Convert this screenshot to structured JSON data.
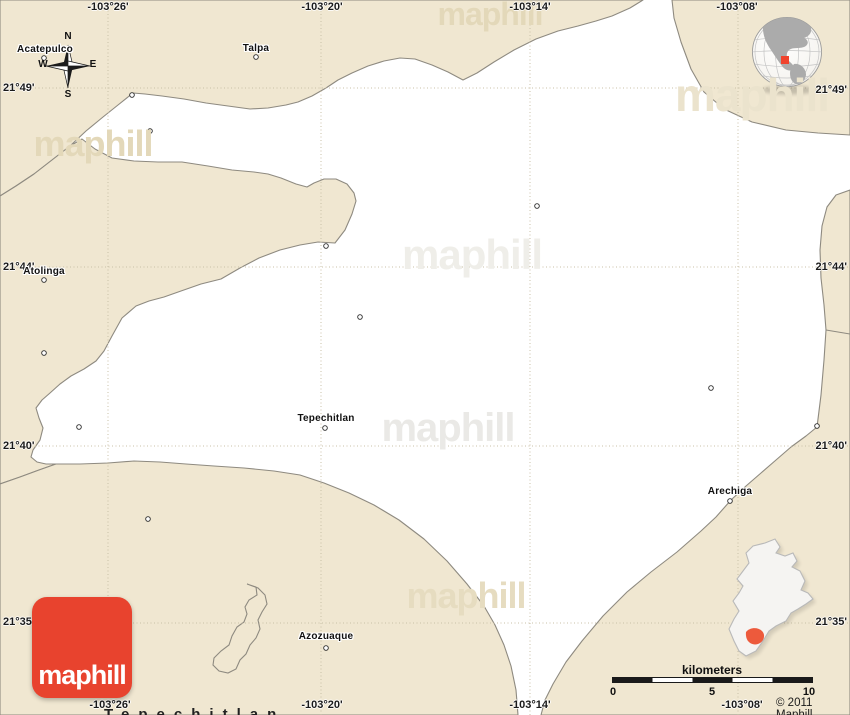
{
  "grid": {
    "lon_top": [
      "-103°26'",
      "-103°20'",
      "-103°14'",
      "-103°08'"
    ],
    "lon_bottom": [
      "-103°26'",
      "-103°20'",
      "-103°14'",
      "-103°08'"
    ],
    "lat_left": [
      "21°49'",
      "21°44'",
      "21°40'",
      "21°35'"
    ],
    "lat_right": [
      "21°49'",
      "21°44'",
      "21°40'",
      "21°35'"
    ]
  },
  "places": {
    "acatepulco": "Acatepulco",
    "talpa": "Talpa",
    "atolinga": "Atolinga",
    "tepechitlan": "Tepechitlan",
    "arechiga": "Arechiga",
    "azozuaque": "Azozuaque"
  },
  "compass": {
    "n": "N",
    "s": "S",
    "e": "E",
    "w": "W"
  },
  "scale_bar": {
    "label": "kilometers",
    "ticks": [
      "0",
      "5",
      "10"
    ]
  },
  "branding": {
    "logo_text": "maphill",
    "watermark": "maphill",
    "copyright": "© 2011 Maphill"
  },
  "map_title": "Tepechitlan",
  "colors": {
    "land_beige": "#f0e7d1",
    "region_white": "#ffffff",
    "border_gray": "#8e8a80",
    "grid_dots": "#c9c0a7",
    "logo_red": "#e8432e",
    "marker_red": "#f0432d"
  }
}
